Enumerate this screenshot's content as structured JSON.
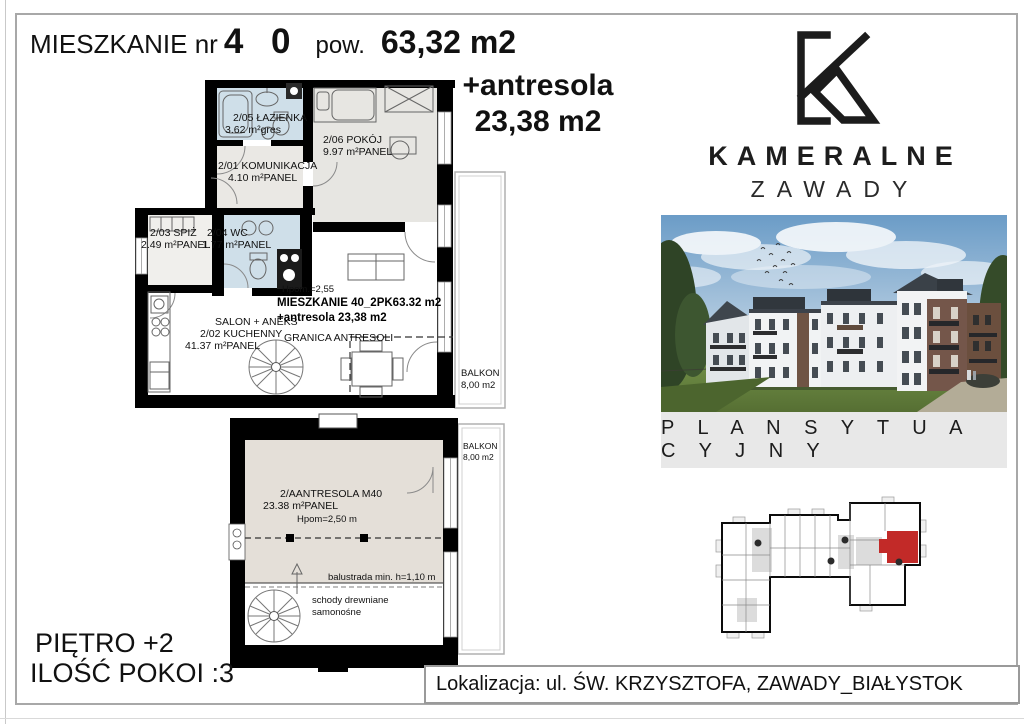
{
  "header": {
    "title": "MIESZKANIE nr",
    "number": "4 0",
    "pow_label": "pow.",
    "area": "63,32 m2",
    "antresola_label": "+antresola",
    "antresola_area": "23,38 m2"
  },
  "main_plan": {
    "bathroom_name": "2/05 ŁAZIENKA",
    "bathroom_area": "3.62 m²gres",
    "room_name": "2/06 POKÓJ",
    "room_area": "9.97 m²PANEL",
    "hall_name": "2/01 KOMUNIKACJA",
    "hall_area": "4.10 m²PANEL",
    "pantry_name": "2/03 SPIŻ",
    "pantry_area": "2.49 m²PANEL",
    "wc_name": "2/04 WC",
    "wc_area": "1.77 m²PANEL",
    "salon_name": "SALON + ANEKS",
    "salon_name2": "2/02 KUCHENNY",
    "salon_area": "41.37 m²PANEL",
    "height_note": "Hpom.=2,55",
    "apartment_line1": "MIESZKANIE 40_2PK63.32 m2",
    "apartment_line2": "+antresola 23,38 m2",
    "granica": "GRANICA ANTRESOLI",
    "balkon_name": "BALKON",
    "balkon_area": "8,00 m2"
  },
  "antresola_plan": {
    "name": "2/AANTRESOLA M40",
    "area": "23.38 m²PANEL",
    "height_note": "Hpom=2,50 m",
    "balustrada": "balustrada min. h=1,10 m",
    "stairs_line1": "schody drewniane",
    "stairs_line2": "samonośne",
    "balkon_name": "BALKON",
    "balkon_area": "8,00 m2"
  },
  "brand": {
    "name": "KAMERALNE",
    "city": "ZAWADY"
  },
  "right_panel": {
    "section_label": "P L A N S Y T U A C Y J N Y"
  },
  "footer": {
    "floor": "PIĘTRO +2",
    "rooms": "ILOŚĆ POKOI :3",
    "location": "Lokalizacja: ul. ŚW. KRZYSZTOFA, ZAWADY_BIAŁYSTOK"
  },
  "colors": {
    "bathroom_floor": "#cfdfe9",
    "room_floor": "#e7e6e2",
    "antresola_floor": "#e4dfd8",
    "wall": "#000000",
    "highlight_unit": "#c22a28",
    "section_strip": "#e8e8e8"
  }
}
